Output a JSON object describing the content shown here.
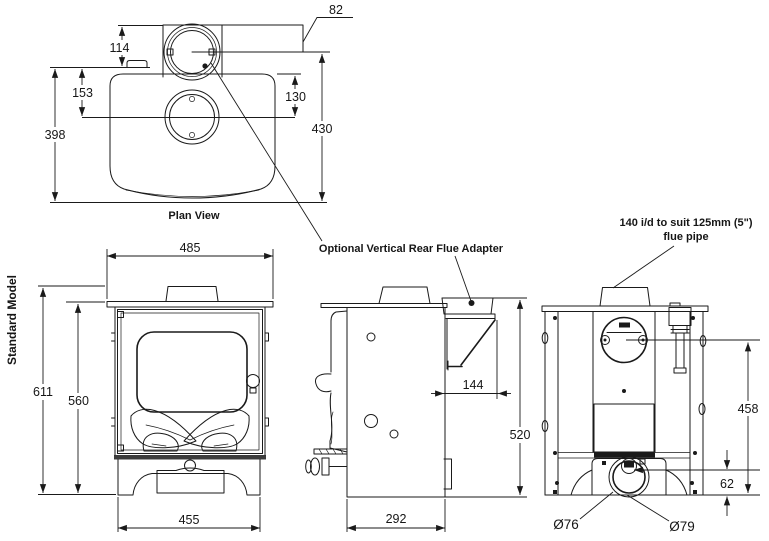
{
  "plan_view": {
    "caption": "Plan View",
    "dim_82": "82",
    "dim_114": "114",
    "dim_153": "153",
    "dim_130": "130",
    "dim_398": "398",
    "dim_430": "430"
  },
  "front_view": {
    "side_label": "Standard Model",
    "dim_485": "485",
    "dim_611": "611",
    "dim_560": "560",
    "dim_455": "455"
  },
  "side_view": {
    "adapter_label": "Optional Vertical Rear Flue Adapter",
    "dim_144": "144",
    "dim_520": "520",
    "dim_292": "292"
  },
  "rear_view": {
    "flue_label_line1": "140 i/d to suit 125mm (5\")",
    "flue_label_line2": "flue pipe",
    "dim_458": "458",
    "dim_62": "62",
    "dia_inner": "Ø76",
    "dia_outer": "Ø79"
  },
  "colors": {
    "line": "#1a1a1a",
    "background": "#ffffff"
  }
}
